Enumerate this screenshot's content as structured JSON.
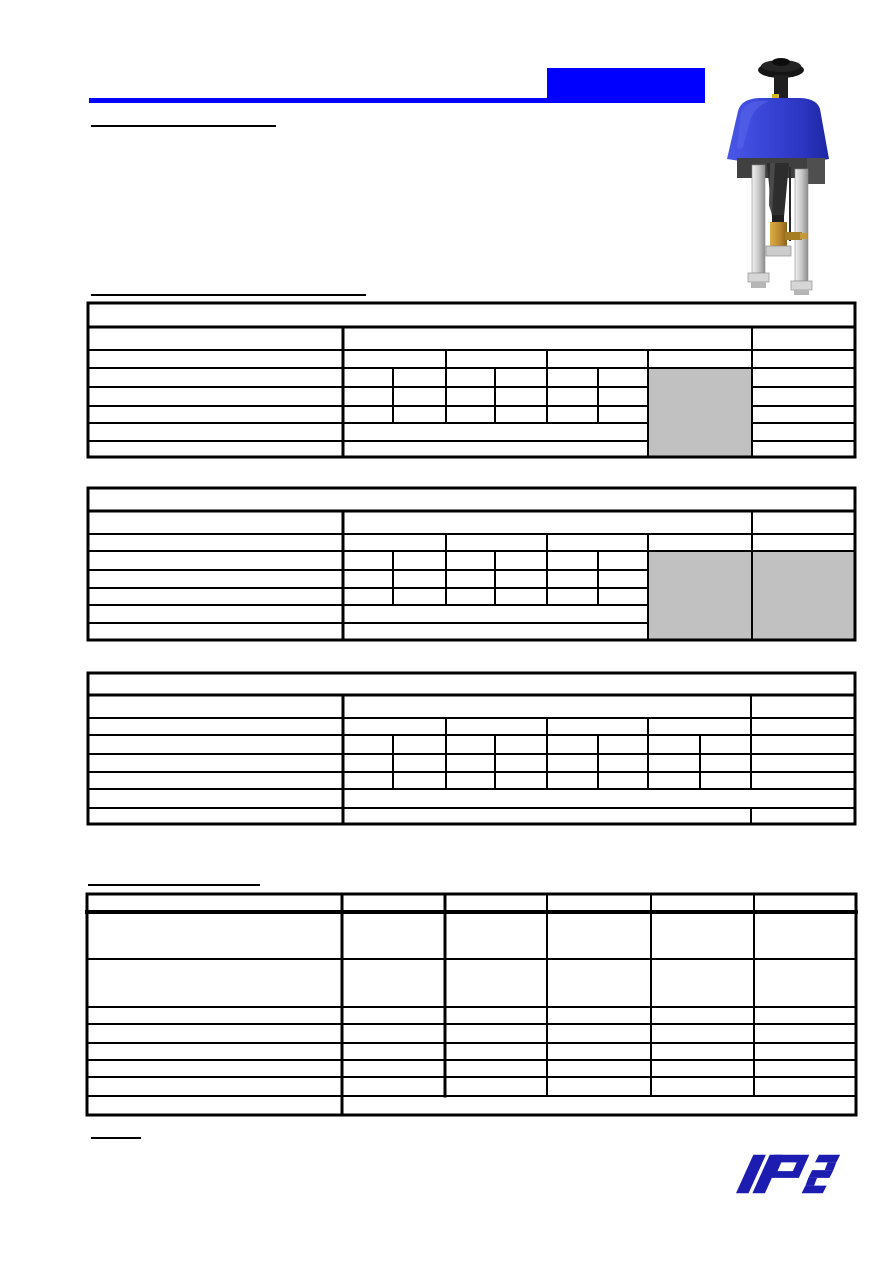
{
  "canvas": {
    "width": 893,
    "height": 1263,
    "background": "#ffffff"
  },
  "colors": {
    "accent": "#0000ff",
    "line": "#000000",
    "shade": "#c1c1c1",
    "logo_blue": "#1c1cb0",
    "page_bg": "#ffffff"
  },
  "header": {
    "marks": [
      {
        "name": "title-rule-blue",
        "x": 89,
        "y": 98,
        "w": 616,
        "h": 5,
        "c": "accent"
      },
      {
        "name": "title-block-blue",
        "x": 547,
        "y": 68,
        "w": 158,
        "h": 35,
        "c": "accent"
      },
      {
        "name": "heading-underline-1",
        "x": 91,
        "y": 125,
        "w": 185,
        "h": 2,
        "c": "line"
      },
      {
        "name": "heading-underline-2",
        "x": 91,
        "y": 294,
        "w": 275,
        "h": 2,
        "c": "line"
      },
      {
        "name": "heading-underline-3",
        "x": 88,
        "y": 884,
        "w": 172,
        "h": 2,
        "c": "line"
      },
      {
        "name": "heading-underline-4",
        "x": 91,
        "y": 1137,
        "w": 50,
        "h": 2,
        "c": "line"
      }
    ]
  },
  "tables": [
    {
      "name": "spec-table-1",
      "fills": [
        {
          "x": 648,
          "y": 368,
          "w": 104,
          "h": 89
        }
      ],
      "hlines": [
        {
          "y": 303,
          "x1": 88,
          "x2": 855,
          "t": 3
        },
        {
          "y": 327,
          "x1": 88,
          "x2": 855,
          "t": 3
        },
        {
          "y": 350,
          "x1": 88,
          "x2": 855,
          "t": 2
        },
        {
          "y": 368,
          "x1": 88,
          "x2": 855,
          "t": 2
        },
        {
          "y": 387,
          "x1": 88,
          "x2": 648,
          "t": 2
        },
        {
          "y": 387,
          "x1": 752,
          "x2": 855,
          "t": 2
        },
        {
          "y": 406,
          "x1": 88,
          "x2": 648,
          "t": 2
        },
        {
          "y": 406,
          "x1": 752,
          "x2": 855,
          "t": 2
        },
        {
          "y": 423,
          "x1": 88,
          "x2": 648,
          "t": 2
        },
        {
          "y": 423,
          "x1": 752,
          "x2": 855,
          "t": 2
        },
        {
          "y": 441,
          "x1": 88,
          "x2": 648,
          "t": 2
        },
        {
          "y": 441,
          "x1": 752,
          "x2": 855,
          "t": 2
        },
        {
          "y": 457,
          "x1": 88,
          "x2": 855,
          "t": 3
        }
      ],
      "vlines": [
        {
          "x": 88,
          "y1": 303,
          "y2": 457,
          "t": 3
        },
        {
          "x": 855,
          "y1": 303,
          "y2": 457,
          "t": 3
        },
        {
          "x": 343,
          "y1": 327,
          "y2": 457,
          "t": 3
        },
        {
          "x": 752,
          "y1": 327,
          "y2": 457,
          "t": 2
        },
        {
          "x": 648,
          "y1": 350,
          "y2": 457,
          "t": 2
        },
        {
          "x": 446,
          "y1": 350,
          "y2": 423,
          "t": 2
        },
        {
          "x": 547,
          "y1": 350,
          "y2": 423,
          "t": 2
        },
        {
          "x": 393,
          "y1": 368,
          "y2": 423,
          "t": 2
        },
        {
          "x": 495,
          "y1": 368,
          "y2": 423,
          "t": 2
        },
        {
          "x": 598,
          "y1": 368,
          "y2": 423,
          "t": 2
        }
      ]
    },
    {
      "name": "spec-table-2",
      "fills": [
        {
          "x": 648,
          "y": 551,
          "w": 104,
          "h": 89
        },
        {
          "x": 752,
          "y": 551,
          "w": 103,
          "h": 89
        }
      ],
      "hlines": [
        {
          "y": 488,
          "x1": 88,
          "x2": 855,
          "t": 3
        },
        {
          "y": 511,
          "x1": 88,
          "x2": 855,
          "t": 3
        },
        {
          "y": 534,
          "x1": 88,
          "x2": 855,
          "t": 2
        },
        {
          "y": 551,
          "x1": 88,
          "x2": 855,
          "t": 2
        },
        {
          "y": 570,
          "x1": 88,
          "x2": 648,
          "t": 2
        },
        {
          "y": 588,
          "x1": 88,
          "x2": 648,
          "t": 2
        },
        {
          "y": 605,
          "x1": 88,
          "x2": 648,
          "t": 2
        },
        {
          "y": 623,
          "x1": 88,
          "x2": 648,
          "t": 2
        },
        {
          "y": 640,
          "x1": 88,
          "x2": 855,
          "t": 3
        }
      ],
      "vlines": [
        {
          "x": 88,
          "y1": 488,
          "y2": 640,
          "t": 3
        },
        {
          "x": 855,
          "y1": 488,
          "y2": 640,
          "t": 3
        },
        {
          "x": 343,
          "y1": 511,
          "y2": 640,
          "t": 3
        },
        {
          "x": 752,
          "y1": 511,
          "y2": 640,
          "t": 2
        },
        {
          "x": 648,
          "y1": 534,
          "y2": 640,
          "t": 2
        },
        {
          "x": 446,
          "y1": 534,
          "y2": 605,
          "t": 2
        },
        {
          "x": 547,
          "y1": 534,
          "y2": 605,
          "t": 2
        },
        {
          "x": 393,
          "y1": 551,
          "y2": 605,
          "t": 2
        },
        {
          "x": 495,
          "y1": 551,
          "y2": 605,
          "t": 2
        },
        {
          "x": 598,
          "y1": 551,
          "y2": 605,
          "t": 2
        }
      ]
    },
    {
      "name": "spec-table-3",
      "fills": [],
      "hlines": [
        {
          "y": 673,
          "x1": 88,
          "x2": 855,
          "t": 3
        },
        {
          "y": 695,
          "x1": 88,
          "x2": 855,
          "t": 3
        },
        {
          "y": 718,
          "x1": 88,
          "x2": 855,
          "t": 2
        },
        {
          "y": 735,
          "x1": 88,
          "x2": 855,
          "t": 2
        },
        {
          "y": 754,
          "x1": 88,
          "x2": 855,
          "t": 2
        },
        {
          "y": 772,
          "x1": 88,
          "x2": 855,
          "t": 2
        },
        {
          "y": 789,
          "x1": 88,
          "x2": 855,
          "t": 2
        },
        {
          "y": 808,
          "x1": 88,
          "x2": 855,
          "t": 2
        },
        {
          "y": 824,
          "x1": 88,
          "x2": 855,
          "t": 3
        }
      ],
      "vlines": [
        {
          "x": 88,
          "y1": 673,
          "y2": 824,
          "t": 3
        },
        {
          "x": 855,
          "y1": 673,
          "y2": 824,
          "t": 3
        },
        {
          "x": 343,
          "y1": 695,
          "y2": 824,
          "t": 3
        },
        {
          "x": 751,
          "y1": 695,
          "y2": 789,
          "t": 2
        },
        {
          "x": 751,
          "y1": 808,
          "y2": 824,
          "t": 2
        },
        {
          "x": 446,
          "y1": 718,
          "y2": 789,
          "t": 2
        },
        {
          "x": 547,
          "y1": 718,
          "y2": 789,
          "t": 2
        },
        {
          "x": 648,
          "y1": 718,
          "y2": 789,
          "t": 2
        },
        {
          "x": 393,
          "y1": 735,
          "y2": 789,
          "t": 2
        },
        {
          "x": 495,
          "y1": 735,
          "y2": 789,
          "t": 2
        },
        {
          "x": 598,
          "y1": 735,
          "y2": 789,
          "t": 2
        },
        {
          "x": 700,
          "y1": 735,
          "y2": 789,
          "t": 2
        }
      ]
    },
    {
      "name": "spec-table-4",
      "fills": [],
      "hlines": [
        {
          "y": 894,
          "x1": 87,
          "x2": 856,
          "t": 3
        },
        {
          "y": 912,
          "x1": 87,
          "x2": 856,
          "t": 4
        },
        {
          "y": 959,
          "x1": 87,
          "x2": 856,
          "t": 2
        },
        {
          "y": 1007,
          "x1": 87,
          "x2": 856,
          "t": 2
        },
        {
          "y": 1024,
          "x1": 87,
          "x2": 856,
          "t": 2
        },
        {
          "y": 1043,
          "x1": 87,
          "x2": 856,
          "t": 2
        },
        {
          "y": 1060,
          "x1": 87,
          "x2": 856,
          "t": 2
        },
        {
          "y": 1077,
          "x1": 87,
          "x2": 856,
          "t": 2
        },
        {
          "y": 1096,
          "x1": 87,
          "x2": 856,
          "t": 2
        },
        {
          "y": 1115,
          "x1": 87,
          "x2": 856,
          "t": 3
        }
      ],
      "vlines": [
        {
          "x": 87,
          "y1": 894,
          "y2": 1115,
          "t": 3
        },
        {
          "x": 856,
          "y1": 894,
          "y2": 1115,
          "t": 3
        },
        {
          "x": 342,
          "y1": 894,
          "y2": 1115,
          "t": 3
        },
        {
          "x": 445,
          "y1": 894,
          "y2": 1096,
          "t": 3
        },
        {
          "x": 547,
          "y1": 894,
          "y2": 1096,
          "t": 2
        },
        {
          "x": 651,
          "y1": 894,
          "y2": 1096,
          "t": 2
        },
        {
          "x": 754,
          "y1": 894,
          "y2": 1096,
          "t": 2
        }
      ]
    }
  ],
  "figures": {
    "product_photo": {
      "description": "blue-electric-valve-actuator",
      "dome_color": "#3a46d8",
      "knob_color": "#1a1a1a",
      "pillar_color": "#c9c9c9",
      "brass_color": "#b8862e"
    },
    "logo": {
      "letters": "PS",
      "color": "#1c1cb0"
    }
  }
}
